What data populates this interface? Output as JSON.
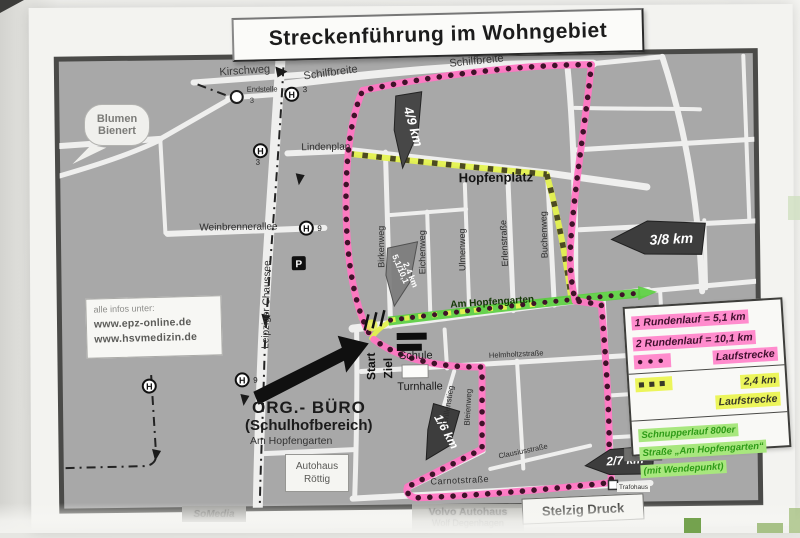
{
  "title": "Streckenführung im Wohngebiet",
  "info_box": {
    "intro": "alle infos unter:",
    "url1": "www.epz-online.de",
    "url2": "www.hsvmedizin.de"
  },
  "streets": {
    "kirschweg": "Kirschweg",
    "schilfbreite": "Schilfbreite",
    "lindenplan": "Lindenplan",
    "hopfenplatz": "Hopfenplatz",
    "weinbrennerallee": "Weinbrennerallee",
    "leipziger_chaussee": "Leipziger Chaussee",
    "birkenweg": "Birkenweg",
    "eichenweg": "Eichenweg",
    "ulmenweg": "Ulmenweg",
    "erlenstrasse": "Erlenstraße",
    "buchenweg": "Buchenweg",
    "am_hopfengarten": "Am Hopfengarten",
    "helmholtzstrasse": "Helmholtzstraße",
    "grillenstieg": "Grillenstieg",
    "bleienweg": "Bleienweg",
    "clausiusstrasse": "Clausiusstraße",
    "carnotstrasse": "Carnotstraße"
  },
  "markers": {
    "m49": "4/9 km",
    "m38": "3/8 km",
    "m51": "5,1/10,1",
    "m24": "2,4 km",
    "m16": "1/6 km",
    "m27": "2/7 km"
  },
  "transit": {
    "h": "H",
    "line3": "3",
    "line9": "9",
    "endstelle": "Endstelle",
    "p": "P"
  },
  "places": {
    "blumen1": "Blumen",
    "blumen2": "Bienert",
    "schule": "Schule",
    "turnhalle": "Turnhalle",
    "start": "Start",
    "ziel": "Ziel",
    "org1": "ORG.- BÜRO",
    "org2": "(Schulhofbereich)",
    "org3": "Am Hopfengarten",
    "autohaus1": "Autohaus",
    "autohaus2": "Röttig",
    "somedia": "SoMedia",
    "volvo1": "Volvo Autohaus",
    "volvo2": "Wolf Degenhagen",
    "stelzig": "Stelzig Druck",
    "trafohaus": "Trafohaus"
  },
  "legend": {
    "row1": "1 Rundenlauf = 5,1 km",
    "row2": "2 Rundenlauf = 10,1 km",
    "row3": "Laufstrecke",
    "dots_symbol": "●●●",
    "squares_symbol": "■■■",
    "row4a": "2,4 km",
    "row4b": "Laufstrecke",
    "row5a": "Schnupperlauf 800er",
    "row5b": "Straße „Am Hopfengarten“",
    "row5c": "(mit Wendepunkt)"
  },
  "colors": {
    "route_pink": "#ff76c3",
    "route_dot": "#3f1229",
    "route_yellow": "#e4f24f",
    "route_square": "#4c4a22",
    "route_green": "#58ce3c",
    "map_gray": "#a8a8a8",
    "street_white": "#efefee"
  }
}
